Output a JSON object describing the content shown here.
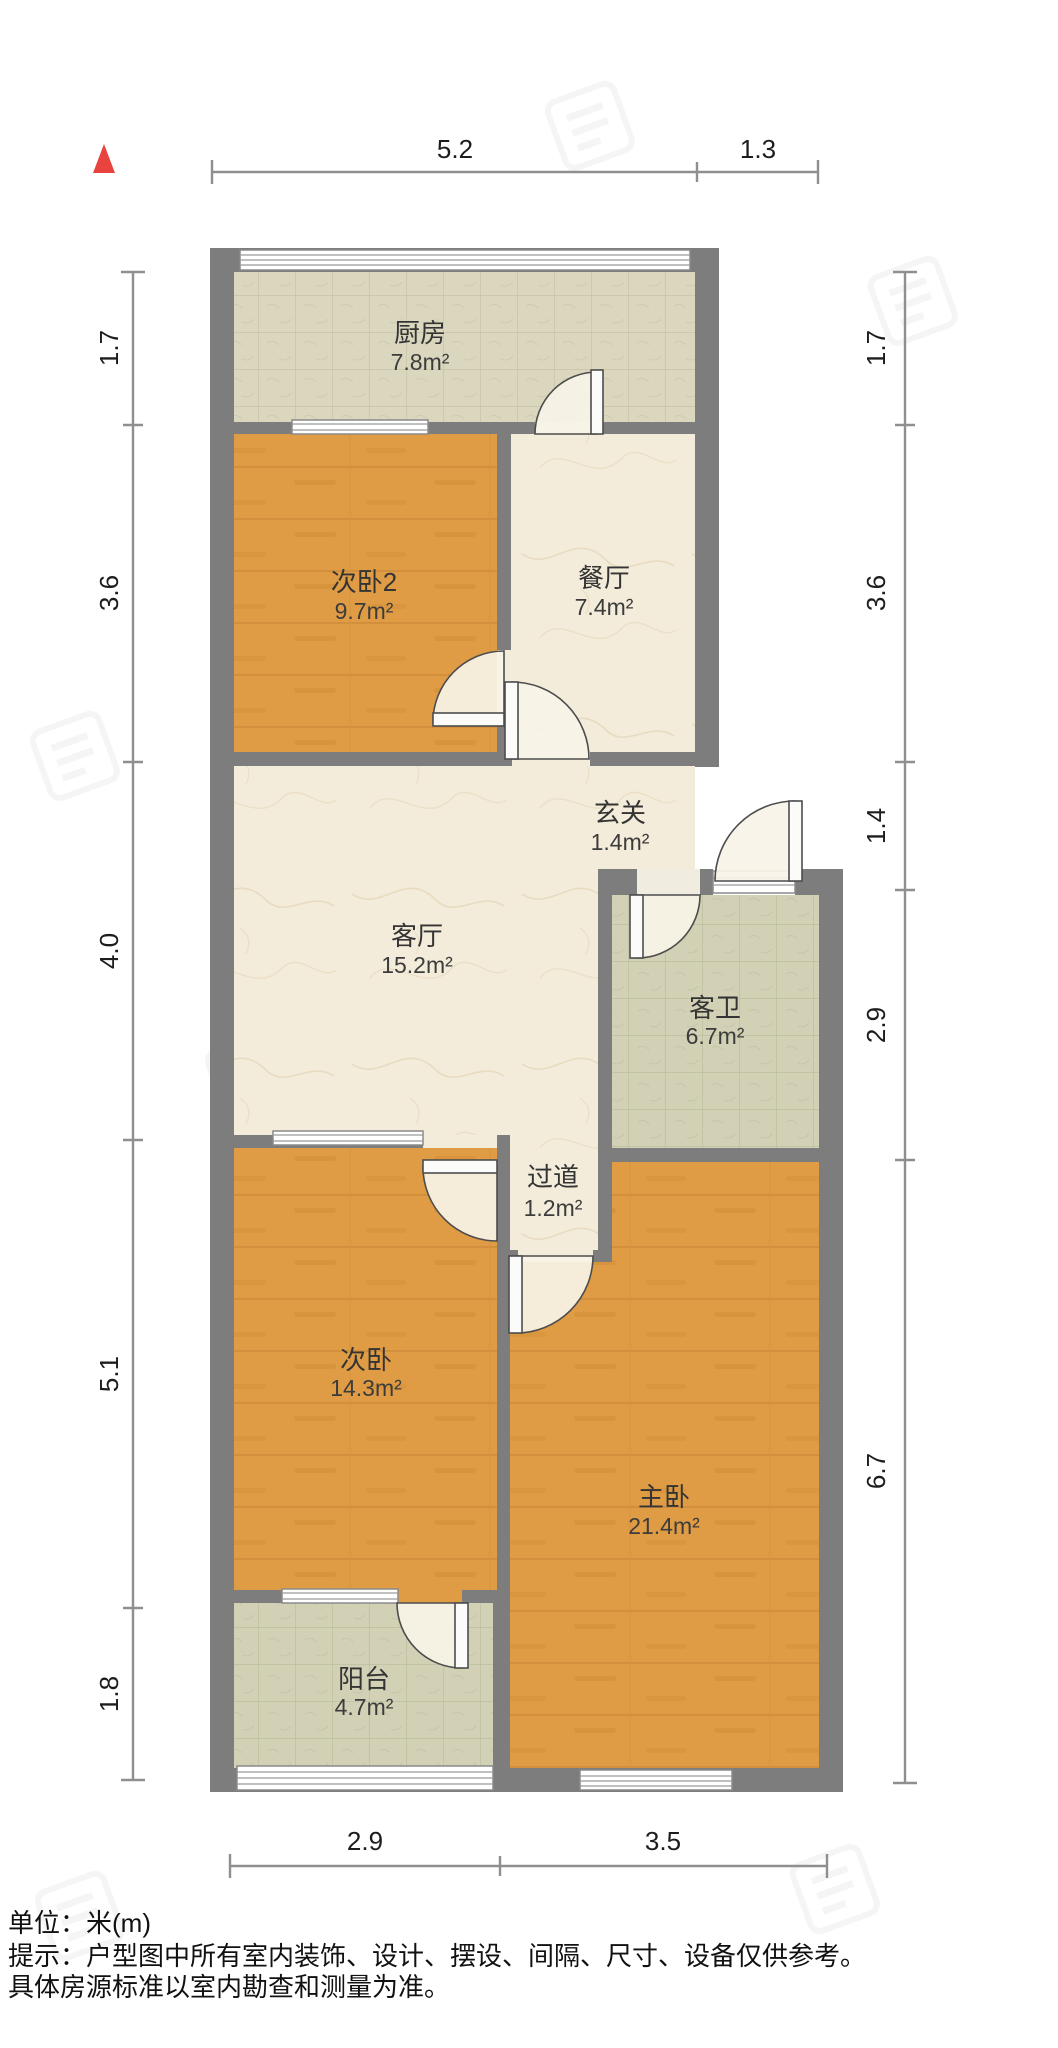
{
  "compass": {
    "direction": "north",
    "color": "#e8433e"
  },
  "rooms": [
    {
      "id": "kitchen",
      "name": "厨房",
      "area": "7.8m²"
    },
    {
      "id": "bedroom2",
      "name": "次卧2",
      "area": "9.7m²"
    },
    {
      "id": "dining",
      "name": "餐厅",
      "area": "7.4m²"
    },
    {
      "id": "entry",
      "name": "玄关",
      "area": "1.4m²"
    },
    {
      "id": "living",
      "name": "客厅",
      "area": "15.2m²"
    },
    {
      "id": "bathroom",
      "name": "客卫",
      "area": "6.7m²"
    },
    {
      "id": "hallway",
      "name": "过道",
      "area": "1.2m²"
    },
    {
      "id": "bedroom",
      "name": "次卧",
      "area": "14.3m²"
    },
    {
      "id": "master",
      "name": "主卧",
      "area": "21.4m²"
    },
    {
      "id": "balcony",
      "name": "阳台",
      "area": "4.7m²"
    }
  ],
  "dimensions": {
    "top": [
      "5.2",
      "1.3"
    ],
    "left": [
      "1.7",
      "3.6",
      "4.0",
      "5.1",
      "1.8"
    ],
    "right": [
      "1.7",
      "3.6",
      "1.4",
      "2.9",
      "6.7"
    ],
    "bottom": [
      "2.9",
      "3.5"
    ]
  },
  "footer": {
    "unit": "单位：米(m)",
    "note1": "提示：户型图中所有室内装饰、设计、摆设、间隔、尺寸、设备仅供参考。",
    "note2": "具体房源标准以室内勘查和测量为准。"
  },
  "colors": {
    "wall": "#7d7d7d",
    "wood_floor": "#e09c44",
    "marble_floor": "#f3ecda",
    "tile_beige": "#dbd7bf",
    "tile_green": "#d2d1b6",
    "compass": "#e8433e"
  }
}
